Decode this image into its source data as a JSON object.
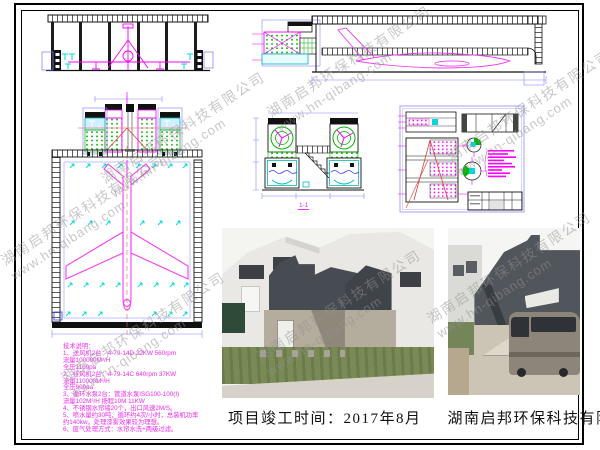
{
  "page": {
    "caption": {
      "completion": "项目竣工时间：2017年8月",
      "company": "湖南启邦环保科技有限公司"
    },
    "watermark": {
      "line1": "湖南启邦环保科技有限公司",
      "line2": "www.hn-qibang.com"
    }
  },
  "tech_notes": {
    "title": "技术说明：",
    "lines": [
      "1、送风机2台：4-79-14D  22KW  560rpm",
      "        流量100000M³/H",
      "        全压1100pa",
      "2、排风机2台：4-79-14C  640rpm  37KW",
      "        流量110000M³/H",
      "        全压900pa",
      "3、循环水泵2台：管道水泵ISG100-100(I)",
      "        流量102M³/H  扬程10M  11KW",
      "4、不锈钢水帘墙20个，出口风速2M/S。",
      "5、喷水量约30吨，循环约4次/小时，总装机功率",
      "   约140kw，处理漆雾效果较为理想。",
      "6、废气处理方式：水帘水洗+两级过滤。"
    ]
  },
  "drawings": {
    "section_label": "1-1"
  },
  "colors": {
    "cad_magenta": "#ff00ff",
    "cad_cyan": "#00d8d8",
    "cad_green": "#00b400",
    "cad_blue": "#8888ff",
    "cad_red": "#e04040",
    "watermark_gray": "#919191",
    "equipment_dark": "#4c5157",
    "grass_green": "#7a8a57"
  }
}
